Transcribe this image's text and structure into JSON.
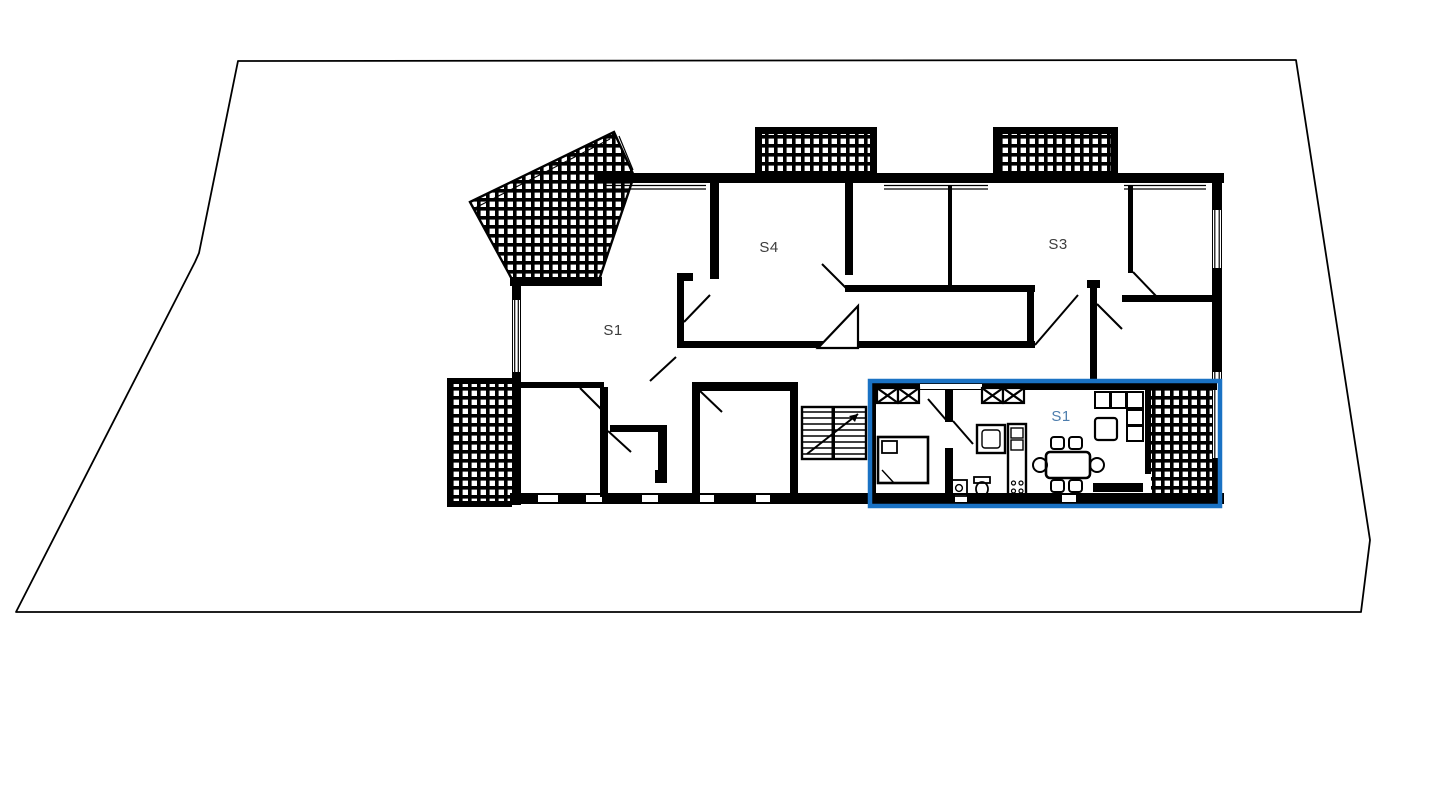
{
  "plan": {
    "labels": {
      "s1_main": "S1",
      "s4": "S4",
      "s3": "S3",
      "s1_highlight": "S1"
    },
    "colors": {
      "wall": "#000000",
      "background": "#ffffff",
      "room_label": "#3d3d3d",
      "highlight": "#1a72c4",
      "highlight_label": "#4d7dad"
    }
  }
}
